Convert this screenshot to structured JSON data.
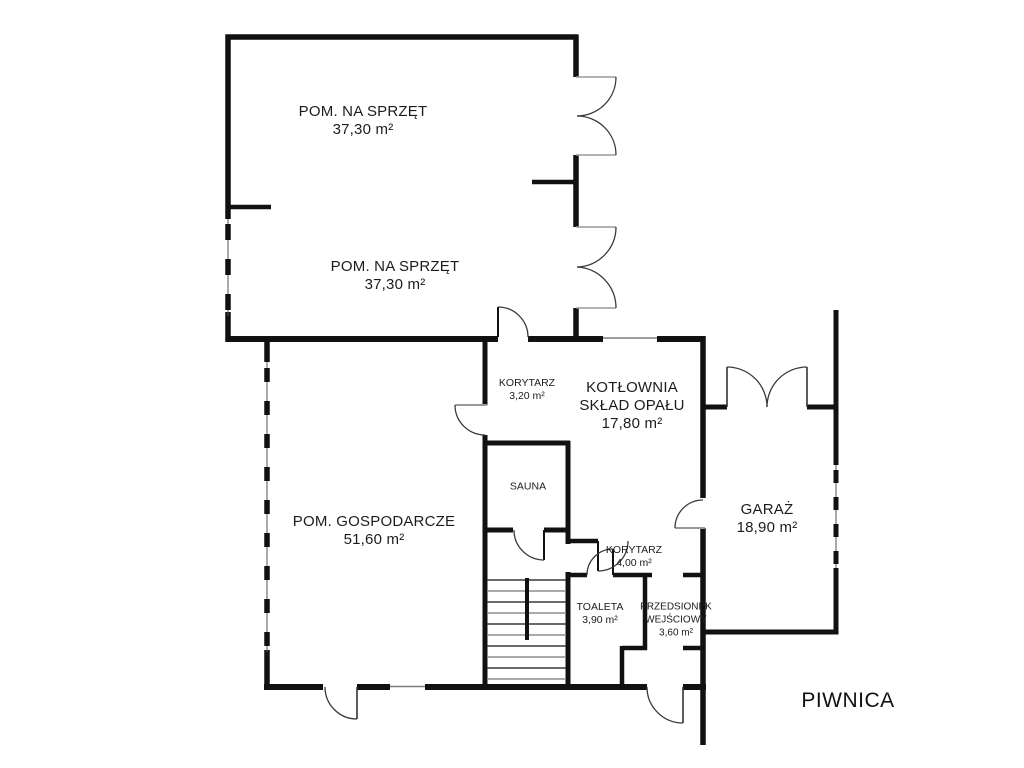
{
  "title": "PIWNICA",
  "colors": {
    "wall": "#111111",
    "background": "#ffffff",
    "door_arc": "#3a3a3a",
    "thin_line": "#8a8a8a"
  },
  "rooms": [
    {
      "id": "pom-na-sprzet-1",
      "name": "POM. NA SPRZĘT",
      "area": "37,30 m²"
    },
    {
      "id": "pom-na-sprzet-2",
      "name": "POM. NA SPRZĘT",
      "area": "37,30 m²"
    },
    {
      "id": "korytarz-gorny",
      "name": "KORYTARZ",
      "area": "3,20 m²"
    },
    {
      "id": "kotlownia",
      "name": "KOTŁOWNIA",
      "name2": "SKŁAD OPAŁU",
      "area": "17,80 m²"
    },
    {
      "id": "pom-gospodarcze",
      "name": "POM. GOSPODARCZE",
      "area": "51,60 m²"
    },
    {
      "id": "sauna",
      "name": "SAUNA",
      "area": ""
    },
    {
      "id": "korytarz-dolny",
      "name": "KORYTARZ",
      "area": "4,00 m²"
    },
    {
      "id": "toaleta",
      "name": "TOALETA",
      "area": "3,90 m²"
    },
    {
      "id": "przedsionek",
      "name": "PRZEDSIONEK",
      "name2": "WEJŚCIOWY",
      "area": "3,60 m²"
    },
    {
      "id": "garaz",
      "name": "GARAŻ",
      "area": "18,90 m²"
    }
  ]
}
